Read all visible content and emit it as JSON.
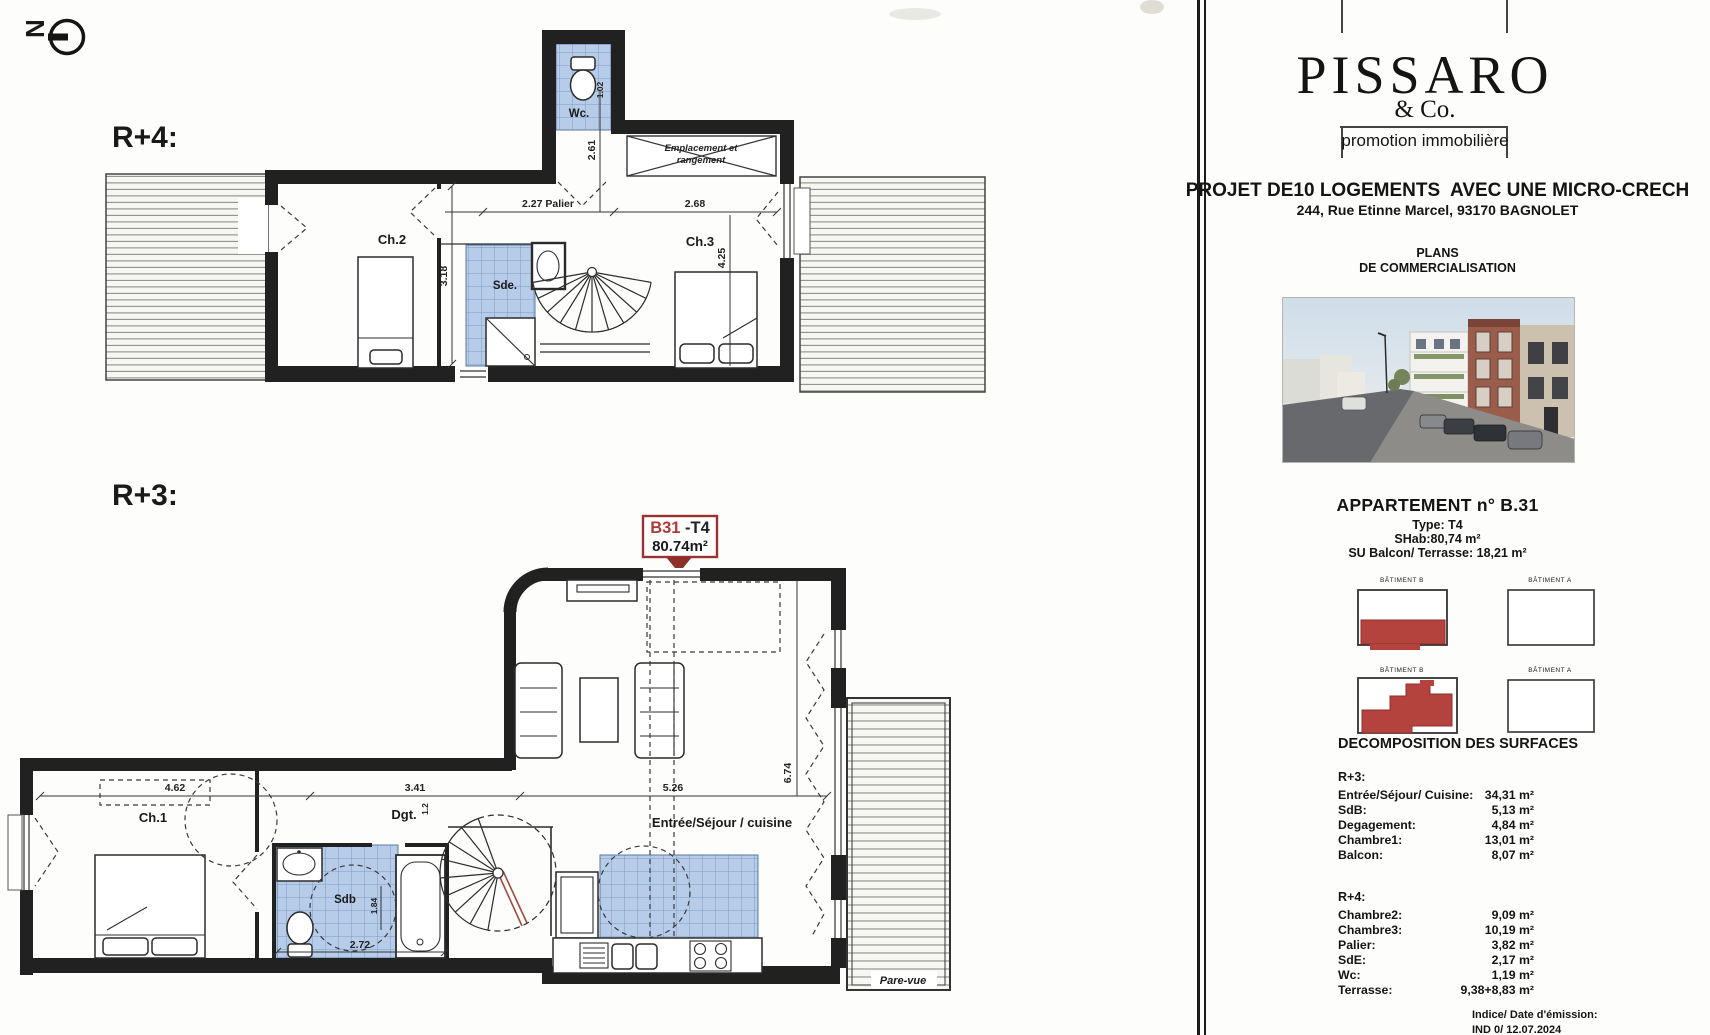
{
  "colors": {
    "tile_blue": "#b7cce8",
    "tile_grid": "#7e9cc5",
    "wall_black": "#212121",
    "marker_red": "#a03c36",
    "keyplan_red": "#b5433d"
  },
  "compass": {
    "letter": "N"
  },
  "plans": {
    "r4": {
      "floor_label": "R+4:",
      "rooms": {
        "ch2": "Ch.2",
        "sde": "Sde.",
        "wc": "Wc.",
        "ch3": "Ch.3"
      },
      "storage_line1": "Emplacement et",
      "storage_line2": "rangement",
      "dims": {
        "palier": "2.27 Palier",
        "d268": "2.68",
        "d261": "2.61",
        "d318": "3.18",
        "d425": "4.25",
        "d102": "1.02"
      }
    },
    "marker": {
      "unit": "B31",
      "type": " -T4",
      "area": "80.74m²"
    },
    "r3": {
      "floor_label": "R+3:",
      "rooms": {
        "ch1": "Ch.1",
        "dgt": "Dgt.",
        "sdb": "Sdb",
        "sejour": "Entrée/Séjour / cuisine",
        "pare_vue": "Pare-vue"
      },
      "dims": {
        "d462": "4.62",
        "d341": "3.41",
        "d12": "1.2",
        "d526": "5.26",
        "d674": "6.74",
        "d184": "1.84",
        "d272": "2.72"
      }
    }
  },
  "sidebar": {
    "logo": {
      "name": "PISSARO",
      "sub": "& Co.",
      "tagline": "promotion immobilière"
    },
    "project": {
      "title": "PROJET DE10 LOGEMENTS  AVEC UNE MICRO-CRECH",
      "address": "244, Rue Etinne Marcel, 93170 BAGNOLET"
    },
    "plans_heading": {
      "line1": "PLANS",
      "line2": "DE COMMERCIALISATION"
    },
    "apartment": {
      "title": "APPARTEMENT n° B.31",
      "type": "Type: T4",
      "shab": "SHab:80,74 m²",
      "su": "SU Balcon/ Terrasse: 18,21 m²"
    },
    "keyplans": {
      "row1_left_label": "BÂTIMENT B",
      "row1_right_label": "BÂTIMENT A",
      "row2_left_label": "BÂTIMENT B",
      "row2_right_label": "BÂTIMENT A"
    },
    "surfaces": {
      "title": "DECOMPOSITION DES SURFACES",
      "r3_label": "R+3:",
      "r3_rows": [
        [
          "Entrée/Séjour/ Cuisine:",
          "34,31 m²"
        ],
        [
          "SdB:",
          "5,13 m²"
        ],
        [
          "Degagement:",
          "4,84 m²"
        ],
        [
          "Chambre1:",
          "13,01 m²"
        ],
        [
          "Balcon:",
          "8,07 m²"
        ]
      ],
      "r4_label": "R+4:",
      "r4_rows": [
        [
          "Chambre2:",
          "9,09 m²"
        ],
        [
          "Chambre3:",
          "10,19 m²"
        ],
        [
          "Palier:",
          "3,82 m²"
        ],
        [
          "SdE:",
          "2,17 m²"
        ],
        [
          "Wc:",
          "1,19 m²"
        ],
        [
          "Terrasse:",
          "9,38+8,83 m²"
        ]
      ]
    },
    "emission": {
      "label": "Indice/ Date d'émission:",
      "value": "IND 0/ 12.07.2024"
    }
  }
}
